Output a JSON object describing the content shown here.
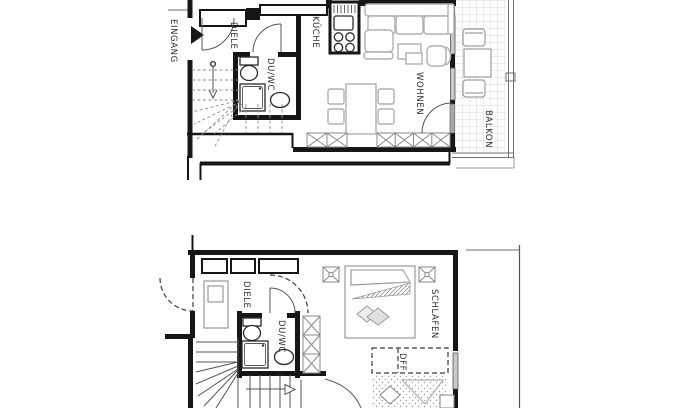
{
  "floorplan": {
    "colors": {
      "wall": "#161616",
      "furniture": "#b0b0b0",
      "fixture": "#2a2a2a",
      "balcony_grid": "#d8d8d8",
      "background": "#ffffff"
    },
    "upper_floor": {
      "labels": {
        "entrance": "EINGANG",
        "hall": "DIELE",
        "bath": "DU/WC",
        "kitchen": "KÜCHE",
        "living": "WOHNEN",
        "balcony": "BALKON"
      }
    },
    "lower_floor": {
      "labels": {
        "hall": "DIELE",
        "bath": "DU/WC",
        "bedroom": "SCHLAFEN",
        "roof_window": "DFF"
      }
    }
  }
}
